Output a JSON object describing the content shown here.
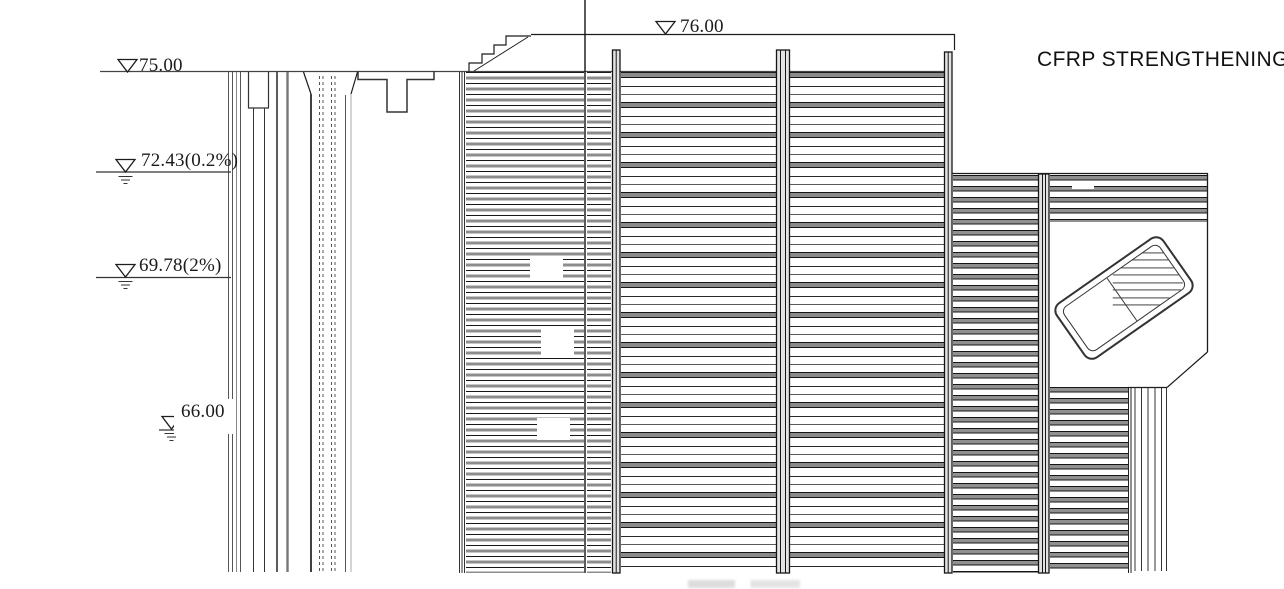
{
  "drawing": {
    "title": "CFRP STRENGTHENING",
    "elevation_labels": {
      "e75": "75.00",
      "e7243": "72.43(0.2%)",
      "e6978": "69.78(2%)",
      "e66": "66.00",
      "e76": "76.00"
    },
    "colors": {
      "line": "#1c1c1c",
      "hatch_gray": "#8d8d8d",
      "background": "#ffffff"
    }
  }
}
